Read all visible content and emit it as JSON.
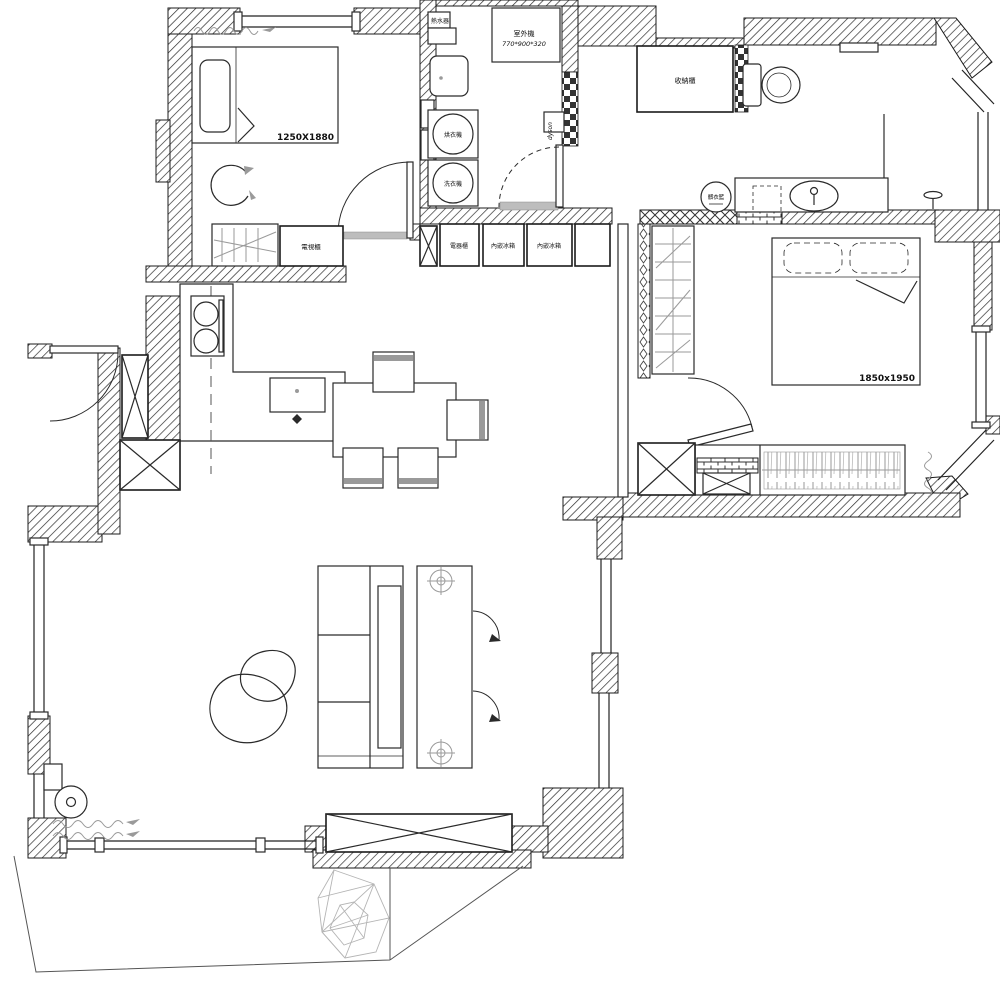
{
  "labels": {
    "water_heater": "熱水器",
    "outdoor_unit": "室外機",
    "outdoor_unit_size": "770*900*320",
    "dyson": "dyson",
    "dryer": "烘衣機",
    "washer": "洗衣機",
    "storage_cabinet": "收納櫃",
    "laundry_basket": "髒衣籃",
    "tv_cabinet": "電視櫃",
    "appliance_cabinet": "電器櫃",
    "built_in_fridge_1": "內嵌冰箱",
    "built_in_fridge_2": "內嵌冰箱",
    "bed1_dimensions": "1250X1880",
    "bed2_dimensions": "1850x1950"
  },
  "colors": {
    "wall_line": "#1b1b1b",
    "furniture_line": "#2a2a2a",
    "light_line": "#9a9a9a",
    "threshold": "#bdbdbd",
    "background": "#ffffff"
  }
}
